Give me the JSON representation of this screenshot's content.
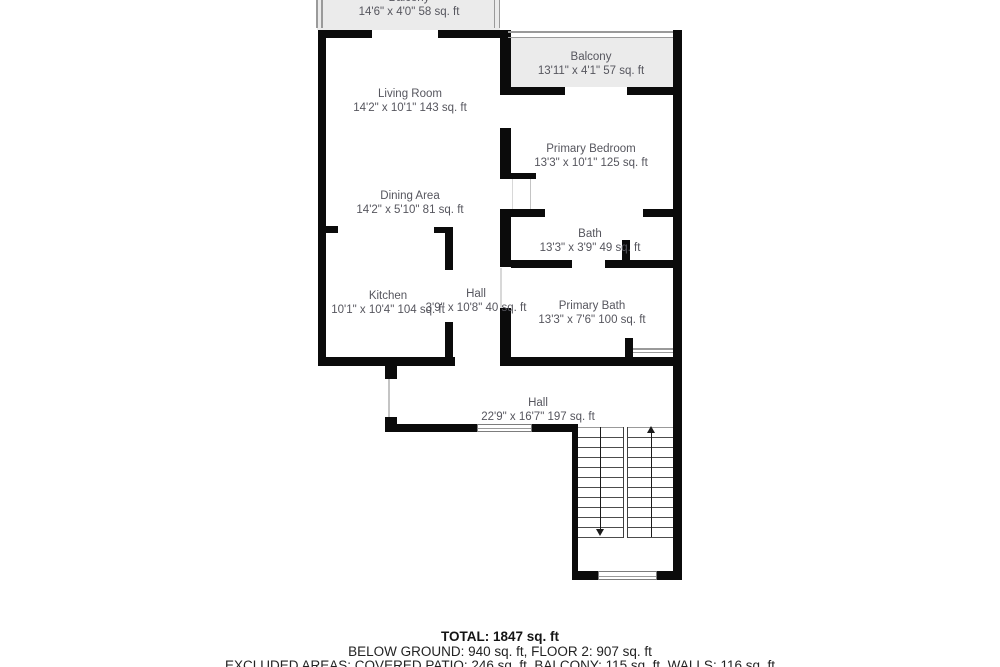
{
  "colors": {
    "wall": "#0b0b0b",
    "balcony_fill": "#ebebeb",
    "railing": "#9a9a9a",
    "room_text": "#56565e",
    "summary_text": "#232323"
  },
  "rooms": {
    "balcony_top": {
      "name": "Balcony",
      "dims": "14'6\" x 4'0\" 58 sq. ft"
    },
    "living_room": {
      "name": "Living Room",
      "dims": "14'2\" x 10'1\" 143 sq. ft"
    },
    "dining_area": {
      "name": "Dining Area",
      "dims": "14'2\" x 5'10\" 81 sq. ft"
    },
    "kitchen": {
      "name": "Kitchen",
      "dims": "10'1\" x 10'4\" 104 sq. ft"
    },
    "hall_upper": {
      "name": "Hall",
      "dims": "3'9\" x 10'8\" 40 sq. ft"
    },
    "balcony_right": {
      "name": "Balcony",
      "dims": "13'11\" x 4'1\" 57 sq. ft"
    },
    "primary_bedroom": {
      "name": "Primary Bedroom",
      "dims": "13'3\" x 10'1\" 125 sq. ft"
    },
    "bath": {
      "name": "Bath",
      "dims": "13'3\" x 3'9\" 49 sq. ft"
    },
    "primary_bath": {
      "name": "Primary Bath",
      "dims": "13'3\" x 7'6\" 100 sq. ft"
    },
    "hall_lower": {
      "name": "Hall",
      "dims": "22'9\" x 16'7\" 197 sq. ft"
    }
  },
  "summary": {
    "total": "TOTAL: 1847 sq. ft",
    "floors": "BELOW GROUND: 940 sq. ft, FLOOR 2: 907 sq. ft",
    "excluded": "EXCLUDED AREAS: COVERED PATIO: 246 sq. ft, BALCONY: 115 sq. ft, WALLS: 116 sq. ft"
  },
  "icons": {
    "stairs_up": "stairs-up-arrow",
    "stairs_down": "stairs-down-arrow"
  }
}
